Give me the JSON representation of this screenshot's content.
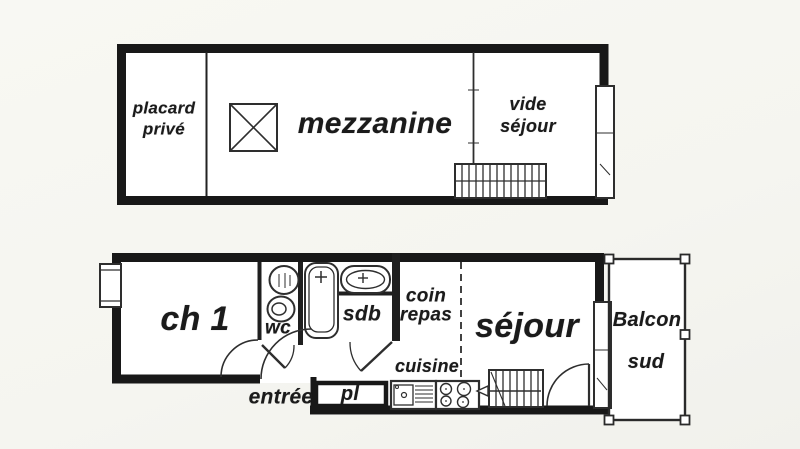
{
  "canvas": {
    "width": 800,
    "height": 449,
    "background": "#f6f6f1",
    "paper": "#ffffff",
    "wall_color": "#181818",
    "ink_color": "#2e2e2e",
    "text_color": "#1b1b1b"
  },
  "upper_floor": {
    "labels": {
      "placard_line1": "placard",
      "placard_line2": "privé",
      "mezzanine": "mezzanine",
      "vide_line1": "vide",
      "vide_line2": "séjour"
    },
    "icons": [
      "floor-opening-icon",
      "mezzanine-railing",
      "stairs-icon",
      "window-bay-icon"
    ]
  },
  "lower_floor": {
    "labels": {
      "ch1": "ch 1",
      "wc": "wc",
      "sdb": "sdb",
      "coin_line1": "coin",
      "coin_line2": "repas",
      "cuisine": "cuisine",
      "sejour": "séjour",
      "entree": "entrée",
      "pl": "pl",
      "balcon_line1": "Balcon",
      "balcon_line2": "sud"
    },
    "icons": [
      "bathtub-icon",
      "washbasin-icon",
      "toilet-icon",
      "kitchen-sink-icon",
      "stove-icon",
      "stairs-icon",
      "door-arc-icon",
      "window-icon",
      "balcony-railing-icon"
    ]
  }
}
